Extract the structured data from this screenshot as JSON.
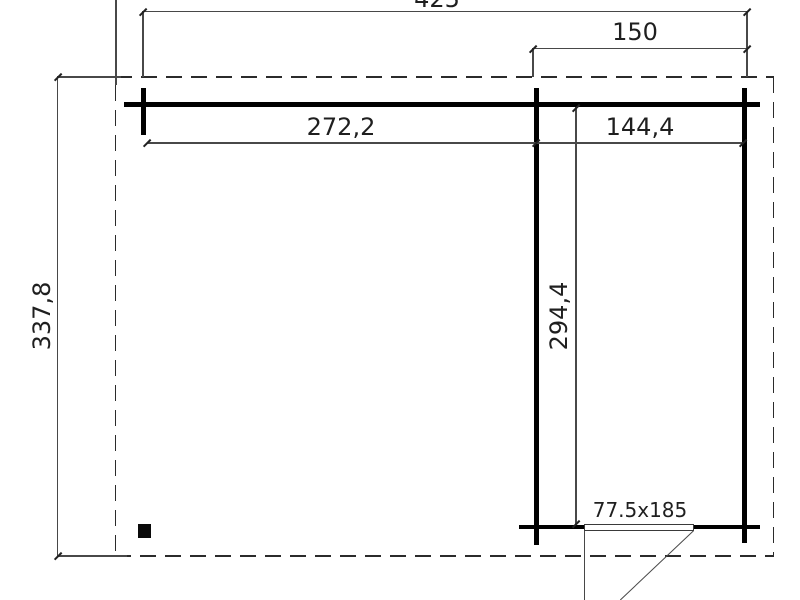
{
  "drawing": {
    "kind": "cabin-floor-plan",
    "dimensions": {
      "overall_width": "425",
      "right_section_width": "150",
      "left_section_inner_width": "272,2",
      "right_section_inner_width": "144,4",
      "right_section_inner_depth": "294,4",
      "overall_depth": "337,8",
      "door_size": "77.5x185"
    },
    "colors": {
      "wall": "#000000",
      "thin_line": "#484848",
      "text": "#1f1f1f",
      "background": "#ffffff"
    }
  }
}
